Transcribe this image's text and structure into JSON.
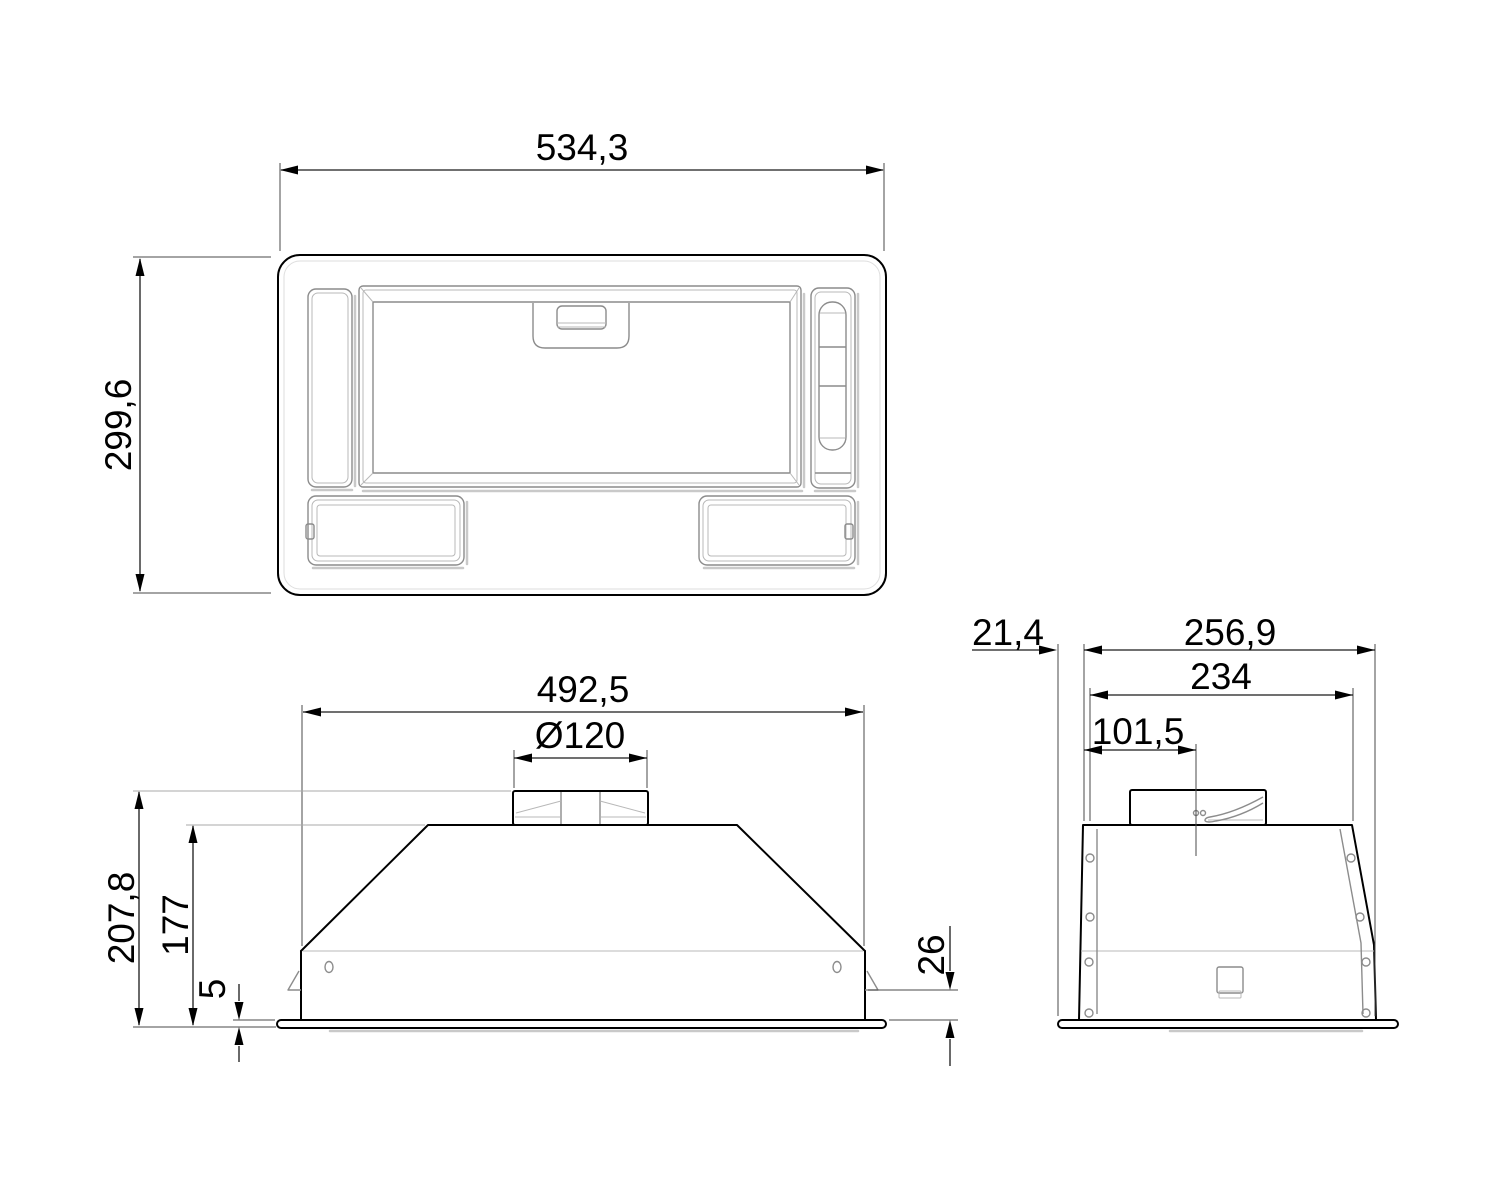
{
  "drawing_title": "built-in-cooker-hood-dimension-drawing",
  "colors": {
    "outline": "#000000",
    "secondary_line": "#8c8c8c",
    "dimension_line": "#1a1a1a",
    "background": "#ffffff"
  },
  "views": {
    "top": {
      "width": "534,3",
      "depth": "299,6"
    },
    "front": {
      "width": "492,5",
      "duct_diameter": "Ø120",
      "height_total": "207,8",
      "height_body": "177",
      "flange_thickness": "5",
      "clip_to_flange": "26"
    },
    "side": {
      "flange_overhang": "21,4",
      "depth_total": "256,9",
      "depth_body": "234",
      "duct_center_from_front": "101,5"
    }
  }
}
